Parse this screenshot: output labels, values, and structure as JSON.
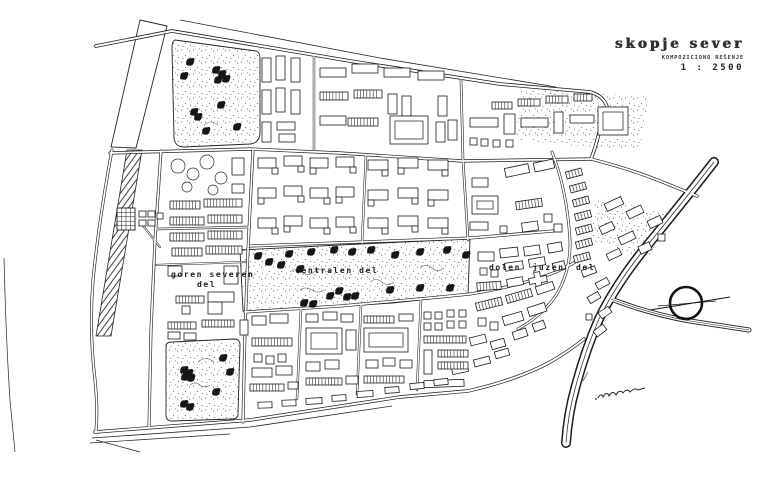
{
  "sheet": {
    "title": "skopje sever",
    "subtitle": "KOMPOZICIONO REŠENJE",
    "scale": "1 : 2500"
  },
  "districts": {
    "goren_line1": "goren severen",
    "goren_line2": "del",
    "centralen": "centralen del",
    "dolen": "dolen juzen del"
  },
  "symbols": {
    "compass": "circle-with-axis-line",
    "signature": "handwritten-signature"
  },
  "colors": {
    "ink": "#1c1c1c",
    "paper": "#ffffff"
  }
}
